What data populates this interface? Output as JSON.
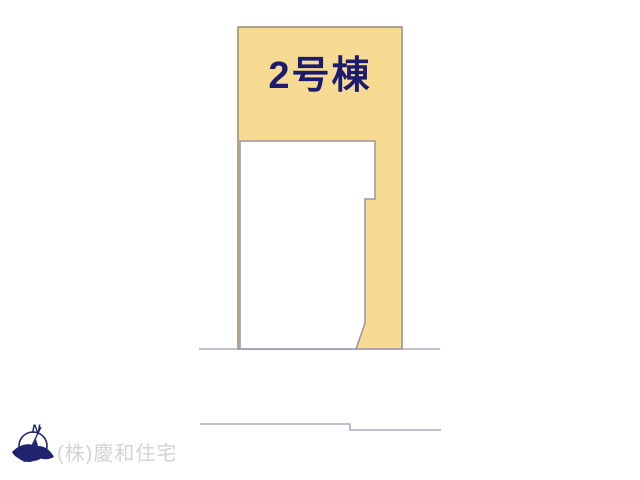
{
  "page": {
    "background_color": "#ffffff",
    "type": "real-estate-site-plan"
  },
  "plot": {
    "label": "2号棟",
    "label_color": "#1b1c70",
    "fill_color": "#f8db92",
    "border_color": "#9e9181"
  },
  "building": {
    "fill_color": "#ffffff",
    "border_color": "#9c94a2"
  },
  "roads": {
    "line_color": "#9a9ab8"
  },
  "compass": {
    "letter": "N",
    "color": "#1f2370"
  },
  "footer": {
    "company": "(株)慶和住宅",
    "color": "#d3d3d3"
  }
}
